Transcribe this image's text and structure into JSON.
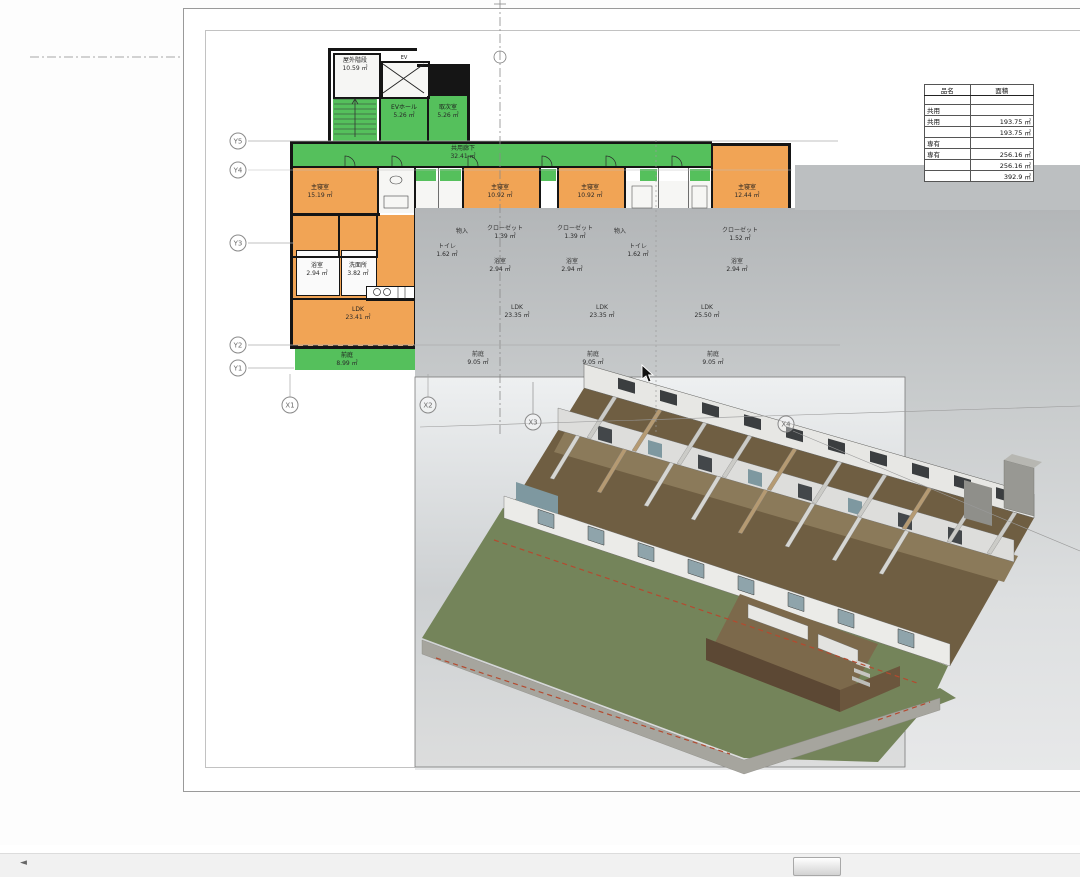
{
  "app": {
    "view_title": "floor-plan-and-3d-view"
  },
  "colors": {
    "common_area": "#55c05c",
    "private_area": "#f1a455",
    "wall": "#151515",
    "grass": "#74845a",
    "red_dash": "#b44a2f"
  },
  "grid": {
    "y": [
      "Y5",
      "Y4",
      "Y3",
      "Y2",
      "Y1"
    ],
    "x": [
      "X1",
      "X2",
      "X3",
      "X4"
    ]
  },
  "plan": {
    "outdoor_stair": {
      "n": "屋外階段",
      "a": "10.59 ㎡"
    },
    "ev": "EV",
    "ev_hall": {
      "n": "EVホール",
      "a": "5.26 ㎡"
    },
    "toritsugi": {
      "n": "取次室",
      "a": "5.26 ㎡"
    },
    "corridor": {
      "n": "共用廊下",
      "a": "32.41 ㎡"
    },
    "bed1": {
      "n": "主寝室",
      "a": "15.19 ㎡"
    },
    "bed2": {
      "n": "主寝室",
      "a": "10.92 ㎡"
    },
    "bed3": {
      "n": "主寝室",
      "a": "10.92 ㎡"
    },
    "bed4": {
      "n": "主寝室",
      "a": "12.44 ㎡"
    },
    "closet1": {
      "n": "クローゼット",
      "a": "1.39 ㎡"
    },
    "closet2": {
      "n": "クローゼット",
      "a": "1.39 ㎡"
    },
    "closet3": {
      "n": "クローゼット",
      "a": "1.52 ㎡"
    },
    "mono1": {
      "n": "物入",
      "a": "1.39 ㎡"
    },
    "mono2": {
      "n": "物入",
      "a": "1.39 ㎡"
    },
    "toilet1": {
      "n": "トイレ",
      "a": "1.62 ㎡"
    },
    "toilet2": {
      "n": "トイレ",
      "a": "1.62 ㎡"
    },
    "bath1": {
      "n": "浴室",
      "a": "2.94 ㎡"
    },
    "bath2": {
      "n": "浴室",
      "a": "2.94 ㎡"
    },
    "bath3": {
      "n": "浴室",
      "a": "2.94 ㎡"
    },
    "bath4": {
      "n": "浴室",
      "a": "2.94 ㎡"
    },
    "senmen": {
      "n": "洗面所",
      "a": "3.82 ㎡"
    },
    "ldk1": {
      "n": "LDK",
      "a": "23.41 ㎡"
    },
    "ldk2": {
      "n": "LDK",
      "a": "23.35 ㎡"
    },
    "ldk3": {
      "n": "LDK",
      "a": "23.35 ㎡"
    },
    "ldk4": {
      "n": "LDK",
      "a": "25.50 ㎡"
    },
    "niwa1": {
      "n": "前庭",
      "a": "8.99 ㎡"
    },
    "niwa2": {
      "n": "前庭",
      "a": "9.05 ㎡"
    },
    "niwa3": {
      "n": "前庭",
      "a": "9.05 ㎡"
    },
    "niwa4": {
      "n": "前庭",
      "a": "9.05 ㎡"
    }
  },
  "table": {
    "headers": [
      "品名",
      "面積"
    ],
    "rows": [
      {
        "c1": "",
        "c2": ""
      },
      {
        "c1": "共用",
        "c2": ""
      },
      {
        "c1": "共用",
        "c2": "193.75 ㎡"
      },
      {
        "c1": "",
        "c2": "193.75 ㎡"
      },
      {
        "c1": "専有",
        "c2": ""
      },
      {
        "c1": "専有",
        "c2": "256.16 ㎡"
      },
      {
        "c1": "",
        "c2": "256.16 ㎡"
      },
      {
        "c1": "",
        "c2": "392.9 ㎡"
      }
    ]
  },
  "scroll": {
    "left_arrow": "◄"
  }
}
